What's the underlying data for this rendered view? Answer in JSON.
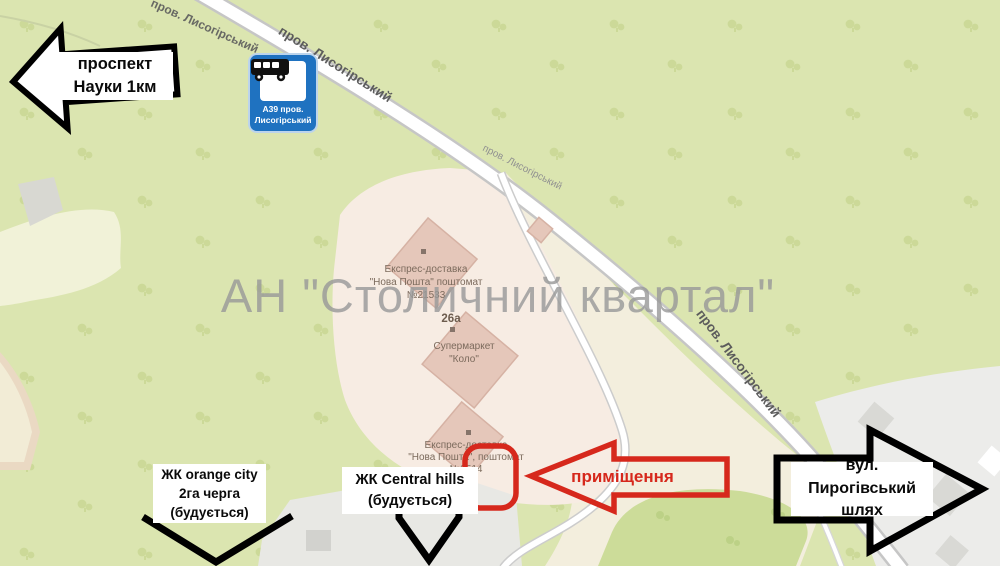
{
  "watermark": "АН \"Столичний квартал\"",
  "roads": {
    "label": "пров. Лисогірський"
  },
  "pois": {
    "np1": {
      "line1": "Експрес-доставка",
      "line2": "\"Нова Пошта\" поштомат",
      "line3": "№21533"
    },
    "house_number": "26а",
    "supermarket": {
      "line1": "Супермаркет",
      "line2": "\"Коло\""
    },
    "np2": {
      "line1": "Експрес-доставка",
      "line2": "\"Нова Пошта\", поштомат",
      "line3": "№2514"
    }
  },
  "annotations": {
    "prospekt_nauky": {
      "line1": "проспект",
      "line2": "Науки 1км"
    },
    "bus_stop": {
      "line1": "А39 пров.",
      "line2": "Лисогірський"
    },
    "zhk_orange_city": {
      "line1": "ЖК orange city",
      "line2": "2га черга",
      "line3": "(будується)"
    },
    "zhk_central_hills": {
      "line1": "ЖК Central hills",
      "line2": "(будується)"
    },
    "premises": {
      "label": "приміщення"
    },
    "pyrohivskyi": {
      "line1": "вул. Пирогівський",
      "line2": "шлях"
    }
  },
  "colors": {
    "annotation_red": "#d6281c",
    "annotation_black": "#000000",
    "bus_sign_blue": "#1f72c0",
    "map_green": "#dbe5b0",
    "map_green_dark": "#ccdc99",
    "tree_green": "#c9d794",
    "zone_pink": "#f7ece3",
    "zone_beige": "#f3eedd",
    "building_pink": "#e5c7ba",
    "zone_gray": "#e8e8e4",
    "road_fill": "#ffffff",
    "road_casing": "#c6c6c6",
    "watermark_gray": "#9a9a9a",
    "poi_text": "#7b6a5c"
  }
}
